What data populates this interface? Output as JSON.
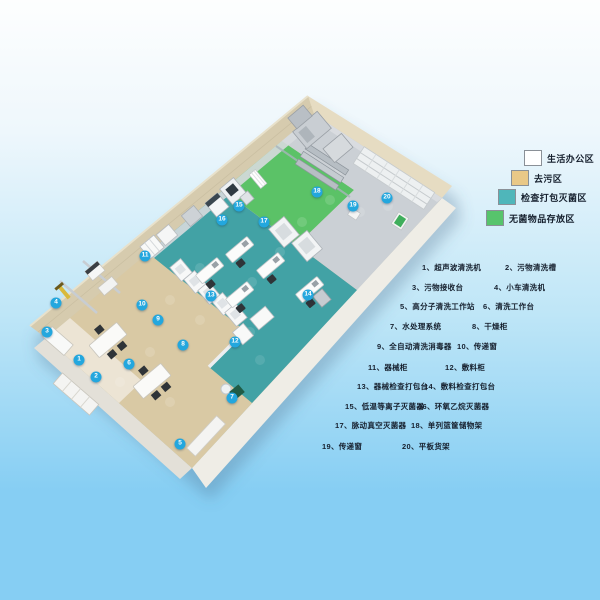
{
  "legend": {
    "items": [
      {
        "label": "生活办公区",
        "color": "#ffffff"
      },
      {
        "label": "去污区",
        "color": "#e9c887"
      },
      {
        "label": "检查打包灭菌区",
        "color": "#4fb6ba"
      },
      {
        "label": "无菌物品存放区",
        "color": "#57c46c"
      }
    ]
  },
  "equipment_list": {
    "items": [
      {
        "label": "1、超声波清洗机"
      },
      {
        "label": "2、污物清洗槽"
      },
      {
        "label": "3、污物接收台"
      },
      {
        "label": "4、小车清洗机"
      },
      {
        "label": "5、高分子清洗工作站"
      },
      {
        "label": "6、清洗工作台"
      },
      {
        "label": "7、水处理系统"
      },
      {
        "label": "8、干燥柜"
      },
      {
        "label": "9、全自动清洗消毒器"
      },
      {
        "label": "10、传递窗"
      },
      {
        "label": "11、器械柜"
      },
      {
        "label": "12、敷料柜"
      },
      {
        "label": "13、器械检查打包台"
      },
      {
        "label": "14、敷料检查打包台"
      },
      {
        "label": "15、低温等离子灭菌器"
      },
      {
        "label": "16、环氧乙烷灭菌器"
      },
      {
        "label": "17、脉动真空灭菌器"
      },
      {
        "label": "18、单列篮筐储物架"
      },
      {
        "label": "19、传递窗"
      },
      {
        "label": "20、平板货架"
      }
    ]
  },
  "floor_markers": [
    {
      "label": "1"
    },
    {
      "label": "2"
    },
    {
      "label": "3"
    },
    {
      "label": "4"
    },
    {
      "label": "5"
    },
    {
      "label": "6"
    },
    {
      "label": "7"
    },
    {
      "label": "8"
    },
    {
      "label": "9"
    },
    {
      "label": "10"
    },
    {
      "label": "11"
    },
    {
      "label": "12"
    },
    {
      "label": "13"
    },
    {
      "label": "14"
    },
    {
      "label": "15"
    },
    {
      "label": "16"
    },
    {
      "label": "17"
    },
    {
      "label": "18"
    },
    {
      "label": "19"
    },
    {
      "label": "20"
    }
  ],
  "colors": {
    "background_top": "#fdfefe",
    "background_mid": "#bfe6f7",
    "background_bottom": "#86cef3",
    "text": "#16202e",
    "marker_bg": "#23a7de",
    "marker_text": "#ffffff",
    "wall_tan": "#d6cbae",
    "wall_tan_light": "#e6dcc2",
    "plinth": "#efede6",
    "plinth_side": "#e3e0d8",
    "floor_office": "#ece4d4",
    "floor_decontamination": "#d9c9a4",
    "floor_inspection": "#42a2a5",
    "floor_sterile": "#5bc267",
    "floor_service": "#cbd0d5"
  }
}
